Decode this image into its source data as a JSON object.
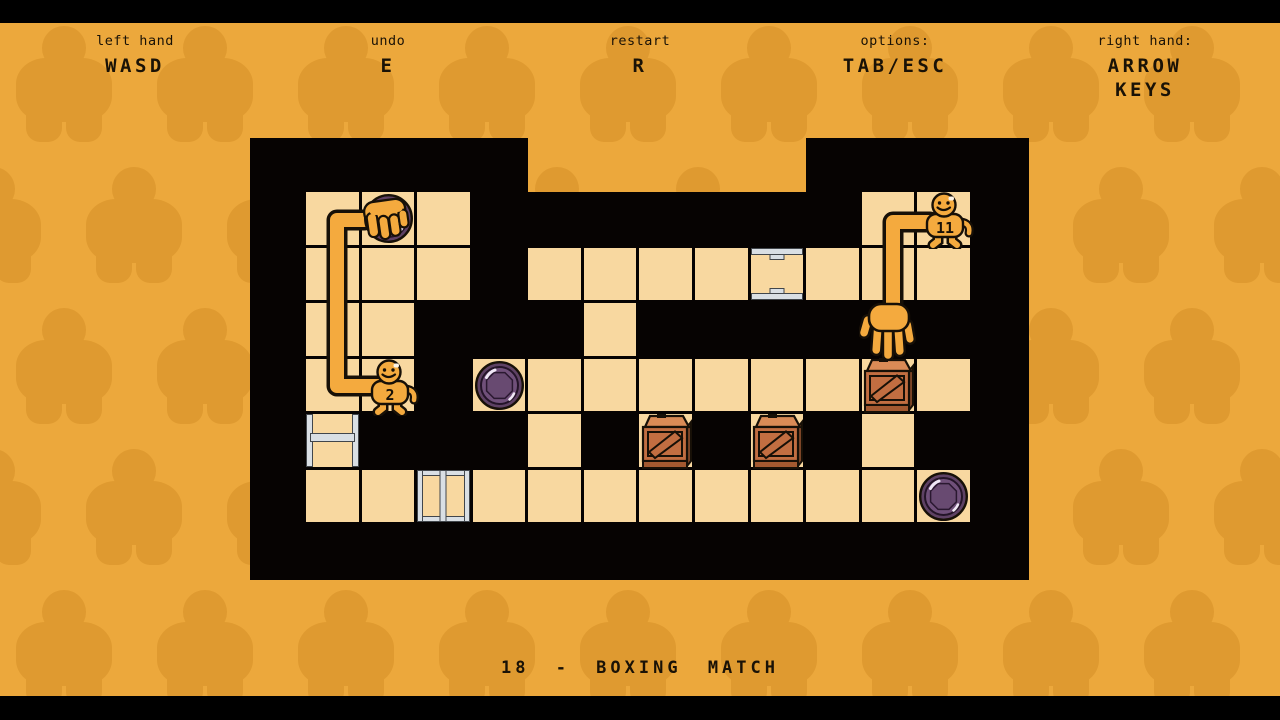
{
  "header": {
    "controls": [
      {
        "id": "left-hand",
        "label": "left hand",
        "value": "WASD"
      },
      {
        "id": "undo",
        "label": "undo",
        "value": "E"
      },
      {
        "id": "restart",
        "label": "restart",
        "value": "R"
      },
      {
        "id": "options",
        "label": "options:",
        "value": "TAB/ESC"
      },
      {
        "id": "right-hand",
        "label": "right hand:",
        "value": "ARROW KEYS"
      }
    ]
  },
  "level": {
    "number": "18",
    "name": "BOXING MATCH",
    "title": "18 - BOXING MATCH"
  },
  "board": {
    "legend": {
      "F": "floor",
      "W": "wall",
      "H": "gate-horizontal",
      "L": "gate-ladder",
      "V": "gate-vertical"
    },
    "map": [
      "FFFWWWWWWWFF",
      "FFFWFFFFHFFF",
      "FFWWWFWWWWWW",
      "FFWFFFFFFFFF",
      "LWWWFWFWFWFW",
      "FFVFFFFFFFFF"
    ],
    "sprites": [
      {
        "type": "disc",
        "name": "purple-disc",
        "col": 1,
        "row": 0
      },
      {
        "type": "disc",
        "name": "purple-disc",
        "col": 3,
        "row": 3
      },
      {
        "type": "disc",
        "name": "purple-disc",
        "col": 11,
        "row": 5
      },
      {
        "type": "crate",
        "name": "wooden-crate",
        "col": 10,
        "row": 3
      },
      {
        "type": "crate",
        "name": "wooden-crate",
        "col": 6,
        "row": 4
      },
      {
        "type": "crate",
        "name": "wooden-crate",
        "col": 8,
        "row": 4
      },
      {
        "type": "character",
        "name": "player-character-2",
        "col": 1,
        "row": 3,
        "label": "2"
      },
      {
        "type": "character",
        "name": "player-character-11",
        "col": 11,
        "row": 0,
        "label": "11"
      },
      {
        "type": "grab-hand",
        "name": "left-hand-sprite",
        "col": 1,
        "row": 0
      },
      {
        "type": "open-hand",
        "name": "right-hand-sprite",
        "col": 10,
        "row": 2
      }
    ]
  },
  "palette": {
    "bg": "#ECA83C",
    "pattern_fig": "#DF9A30",
    "letterbox": "#000000",
    "board": "#060302",
    "tile": "#F8D8A0",
    "silver": "#D9DFE4",
    "silver_edge": "#41464B",
    "character": "#F4AA3E",
    "outline": "#171007",
    "disc_outer": "#5E4164",
    "disc_mid": "#70507A",
    "disc_inner": "#684A71",
    "disc_shine": "#F0E8F6",
    "crate_lid": "#DA8B56",
    "crate_face": "#C26E41",
    "crate_side": "#7D4527",
    "crate_bottom": "#A35930",
    "text": "#1A1206"
  }
}
